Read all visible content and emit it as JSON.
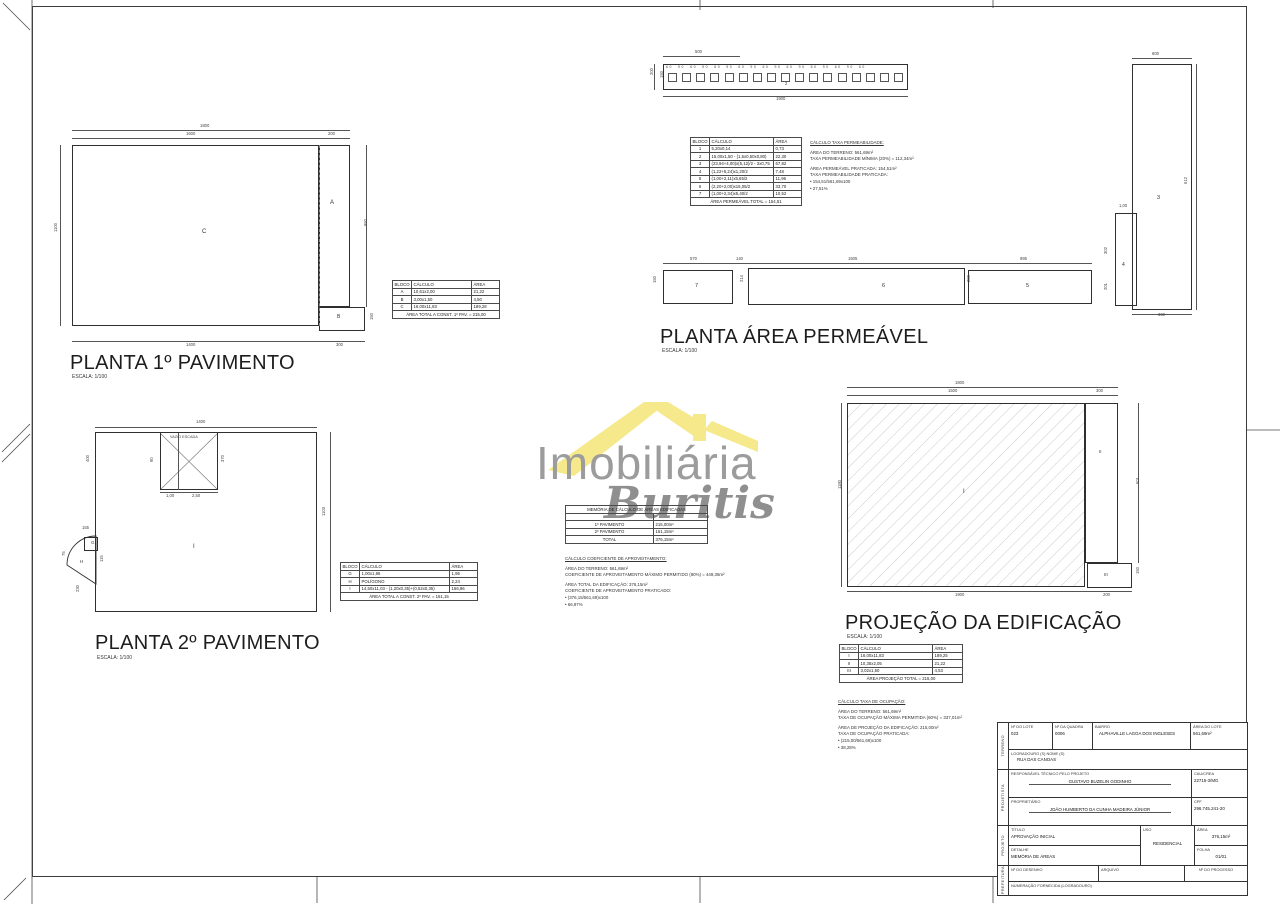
{
  "watermark": {
    "line1": "Imobiliária",
    "line2": "Buritis",
    "roof_color": "#f5e98b",
    "text_color": "#9c9c9c"
  },
  "plan1": {
    "title": "PLANTA 1º PAVIMENTO",
    "scale": "ESCALA: 1/100",
    "table": {
      "cols": [
        16,
        60,
        28
      ],
      "rows": [
        [
          "BLOCO",
          "CÁLCULO",
          "ÁREA"
        ],
        [
          "A",
          "10,61x2,00",
          "21,22"
        ],
        [
          "B",
          "3,00x1,50",
          "4,50"
        ],
        [
          "C",
          "16,00x11,83",
          "189,28"
        ],
        [
          "ÁREA TOTAL A CONST. 1º PAV. = 215,00"
        ]
      ]
    },
    "geo": [
      [
        72,
        130,
        278,
        0
      ],
      [
        72,
        138,
        278,
        0
      ],
      [
        60,
        145,
        0,
        181
      ],
      [
        366,
        145,
        0,
        162
      ],
      [
        72,
        341,
        293,
        0
      ],
      {
        "t": "1800",
        "x": 200,
        "y": 124
      },
      {
        "t": "1600",
        "x": 186,
        "y": 132
      },
      {
        "t": "200",
        "x": 328,
        "y": 132
      },
      {
        "t": "1100",
        "x": 54,
        "y": 232,
        "r": -90
      },
      {
        "t": "950",
        "x": 364,
        "y": 226,
        "r": -90
      },
      {
        "t": "1400",
        "x": 186,
        "y": 343
      },
      {
        "t": "300",
        "x": 336,
        "y": 343
      },
      {
        "t": "150",
        "x": 370,
        "y": 320,
        "r": -90
      },
      {
        "t": "A",
        "x": 330,
        "y": 200,
        "s": 6
      },
      {
        "t": "B",
        "x": 337,
        "y": 315,
        "s": 5
      },
      {
        "t": "C",
        "x": 202,
        "y": 229,
        "s": 6
      }
    ]
  },
  "perm": {
    "title": "PLANTA ÁREA PERMEÁVEL",
    "scale": "ESCALA: 1/100",
    "strip": {
      "squares": 17,
      "ticks": "60  90  60  90  60  90  60  90  60  90  60  90  60  90  60  90  60"
    },
    "strip_geo": [
      [
        663,
        56,
        77,
        0
      ],
      [
        663,
        96,
        245,
        0
      ],
      [
        654,
        64,
        0,
        26
      ],
      {
        "t": "500",
        "x": 695,
        "y": 50
      },
      {
        "t": "1900",
        "x": 776,
        "y": 97
      },
      {
        "t": "200",
        "x": 650,
        "y": 75,
        "r": -90
      },
      {
        "t": "150",
        "x": 660,
        "y": 78,
        "r": -90
      },
      {
        "t": "2",
        "x": 785,
        "y": 82
      }
    ],
    "table": {
      "cols": [
        16,
        64,
        28
      ],
      "rows": [
        [
          "BLOCO",
          "CÁLCULO",
          "ÁREA"
        ],
        [
          "1",
          "5,20x0,14",
          "0,73"
        ],
        [
          "2",
          "15,00x1,50 - (1,5x0,50x0,80)",
          "22,30"
        ],
        [
          "3",
          "(23,94+4,00)x(5,12)/2 - 3x0,75",
          "67,82"
        ],
        [
          "4",
          "(1,22+5,24)x1,20/2",
          "7,48"
        ],
        [
          "5",
          "(1,00+2,11)x5,65/2",
          "11,96"
        ],
        [
          "6",
          "(2,20+2,00)x15,05/2",
          "33,70"
        ],
        [
          "7",
          "(1,00+2,34)x5,40/2",
          "10,52"
        ],
        [
          "ÁREA PERMEÁVEL TOTAL = 154,51"
        ]
      ]
    },
    "calc": {
      "lines": [
        "CÁLCULO TAXA PERMEABILIDADE:",
        "",
        "ÁREA DO TERRENO: 561,69m²",
        "TAXA PERMEABILIDADE MÍNIMA (20%) = 112,34m²",
        "",
        "ÁREA PERMEÁVEL PRATICADA: 154,51m²",
        "TAXA PERMEABILIDADE PRATICADA:",
        "•    154,51/561,69x100",
        "•    27,51%"
      ]
    },
    "geo": [
      [
        663,
        263,
        429,
        0
      ],
      [
        1132,
        58,
        60,
        0
      ],
      [
        1196,
        64,
        0,
        246
      ],
      [
        1132,
        314,
        60,
        0
      ],
      {
        "t": "570",
        "x": 690,
        "y": 257
      },
      {
        "t": "140",
        "x": 736,
        "y": 257
      },
      {
        "t": "1505",
        "x": 848,
        "y": 257
      },
      {
        "t": "995",
        "x": 1020,
        "y": 257
      },
      {
        "t": "150",
        "x": 653,
        "y": 283,
        "r": -90
      },
      {
        "t": "214",
        "x": 740,
        "y": 282,
        "r": -90
      },
      {
        "t": "200",
        "x": 967,
        "y": 282,
        "r": -90
      },
      {
        "t": "600",
        "x": 1152,
        "y": 52
      },
      {
        "t": "612",
        "x": 1184,
        "y": 184,
        "r": -90
      },
      {
        "t": "1,00",
        "x": 1119,
        "y": 204
      },
      {
        "t": "302",
        "x": 1104,
        "y": 254,
        "r": -90
      },
      {
        "t": "201",
        "x": 1104,
        "y": 290,
        "r": -90
      },
      {
        "t": "360",
        "x": 1158,
        "y": 313
      },
      {
        "t": "7",
        "x": 695,
        "y": 284,
        "s": 5.5
      },
      {
        "t": "6",
        "x": 882,
        "y": 284,
        "s": 5.5
      },
      {
        "t": "5",
        "x": 1026,
        "y": 284,
        "s": 5.5
      },
      {
        "t": "3",
        "x": 1157,
        "y": 196,
        "s": 5.5
      },
      {
        "t": "4",
        "x": 1122,
        "y": 263,
        "s": 5
      }
    ]
  },
  "mem": {
    "table": {
      "cols": [
        88,
        54
      ],
      "rows": [
        [
          "MEMÓRIA DE CÁLCULO DE ÁREAS EDIFICADAS"
        ],
        [
          "",
          ""
        ],
        [
          "1º PAVIMENTO",
          "215,00m²"
        ],
        [
          "2º PAVIMENTO",
          "161,15m²"
        ],
        [
          "TOTAL",
          "376,15m²"
        ]
      ]
    }
  },
  "coef": {
    "lines": [
      "CÁLCULO COEFICIENTE DE APROVEITAMENTO:",
      "",
      "ÁREA DO TERRENO: 561,69m²",
      "COEFICIENTE DE APROVEITAMENTO MÁXIMO PERMITIDO (80%) = 449,35m²",
      "",
      "ÁREA TOTAL DA EDIFICAÇÃO: 376,15m²",
      "COEFICIENTE DE APROVEITAMENTO PRATICADO:",
      "•    (376,15/561,69)x100",
      "•    66,97%"
    ]
  },
  "plan2": {
    "title": "PLANTA 2º PAVIMENTO",
    "scale": "ESCALA: 1/100",
    "void_label": "VAZIO ESCADA",
    "table": {
      "cols": [
        16,
        90,
        28
      ],
      "rows": [
        [
          "BLOCO",
          "CÁLCULO",
          "ÁREA"
        ],
        [
          "G",
          "1,00x1,95",
          "1,95"
        ],
        [
          "H",
          "POLÍGONO",
          "2,24"
        ],
        [
          "I",
          "14,50x11,03 - (1,20x0,35)+(0,52x0,35)",
          "156,96"
        ],
        [
          "ÁREA TOTAL A CONST. 2º PAV. = 161,15"
        ]
      ]
    },
    "geo": [
      [
        95,
        427,
        222,
        0
      ],
      [
        330,
        432,
        0,
        180
      ],
      [
        160,
        492,
        58,
        0
      ],
      [
        178,
        433,
        0,
        57
      ],
      {
        "t": "1400",
        "x": 196,
        "y": 420
      },
      {
        "t": "400",
        "x": 86,
        "y": 462,
        "r": -90
      },
      {
        "t": "90",
        "x": 150,
        "y": 462,
        "r": -90
      },
      {
        "t": "370",
        "x": 221,
        "y": 462,
        "r": -90
      },
      {
        "t": "1,00",
        "x": 166,
        "y": 494
      },
      {
        "t": "2,50",
        "x": 192,
        "y": 494
      },
      {
        "t": "1103",
        "x": 322,
        "y": 516,
        "r": -90
      },
      {
        "t": "155",
        "x": 82,
        "y": 526
      },
      {
        "t": "75",
        "x": 62,
        "y": 556,
        "r": -90
      },
      {
        "t": "115",
        "x": 100,
        "y": 562,
        "r": -90
      },
      {
        "t": "230",
        "x": 76,
        "y": 592,
        "r": -90
      },
      {
        "t": "I",
        "x": 193,
        "y": 544,
        "s": 6
      },
      {
        "t": "G",
        "x": 91,
        "y": 541,
        "s": 4.5
      },
      {
        "t": "H",
        "x": 80,
        "y": 560,
        "s": 4.5
      }
    ]
  },
  "proj": {
    "title": "PROJEÇÃO DA EDIFICAÇÃO",
    "scale": "ESCALA: 1/100",
    "table": {
      "cols": [
        18,
        74,
        30
      ],
      "rows": [
        [
          "BLOCO",
          "CÁLCULO",
          "ÁREA"
        ],
        [
          "I",
          "16,00x11,83",
          "189,25"
        ],
        [
          "II",
          "10,35x2,05",
          "21,22"
        ],
        [
          "III",
          "3,02x1,50",
          "4,53"
        ],
        [
          "ÁREA PROJEÇÃO TOTAL = 215,00"
        ]
      ]
    },
    "occup": {
      "lines": [
        "CÁLCULO TAXA DE OCUPAÇÃO:",
        "",
        "ÁREA DO TERRENO: 561,69m²",
        "TAXA DE OCUPAÇÃO MÁXIMA PERMITIDA (60%) = 337,01m²",
        "",
        "ÁREA DE PROJEÇÃO DA EDIFICAÇÃO: 215,00m²",
        "TAXA DE OCUPAÇÃO PRATICADA:",
        "•    (215,00/561,69)x100",
        "•    38,28%"
      ]
    },
    "geo": [
      [
        847,
        387,
        271,
        0
      ],
      [
        847,
        395,
        271,
        0
      ],
      [
        841,
        403,
        0,
        184
      ],
      [
        1138,
        403,
        0,
        160
      ],
      [
        847,
        591,
        285,
        0
      ],
      {
        "t": "1800",
        "x": 955,
        "y": 381
      },
      {
        "t": "1500",
        "x": 948,
        "y": 389
      },
      {
        "t": "300",
        "x": 1096,
        "y": 389
      },
      {
        "t": "1180",
        "x": 838,
        "y": 489,
        "r": -90
      },
      {
        "t": "601",
        "x": 1136,
        "y": 484,
        "r": -90
      },
      {
        "t": "150",
        "x": 1136,
        "y": 574,
        "r": -90
      },
      {
        "t": "1900",
        "x": 955,
        "y": 593
      },
      {
        "t": "200",
        "x": 1103,
        "y": 593
      },
      {
        "t": "I",
        "x": 963,
        "y": 489,
        "s": 6
      },
      {
        "t": "II",
        "x": 1099,
        "y": 450,
        "s": 4.5
      },
      {
        "t": "III",
        "x": 1104,
        "y": 573,
        "s": 4.5
      }
    ]
  },
  "titleblock": {
    "terreno": {
      "v": "TERRENO",
      "lote_label": "Nº DO LOTE",
      "lote": "023",
      "quadra_label": "Nº DA QUADRA",
      "quadra": "0006",
      "bairro_label": "BAIRRO",
      "bairro": "ALPHAVILLE LAGOA DOS INGLESES",
      "area_label": "ÁREA DO LOTE",
      "area": "561,69m²",
      "logradouro_label": "LOGRADOURO (S) NOME (S)",
      "logradouro": "RUA DAS CANOAS"
    },
    "projetista": {
      "v": "PROJETISTA",
      "resp_label": "RESPONSÁVEL TÉCNICO PELO PROJETO",
      "resp": "GUSTAVO BUZELIN GODINHO",
      "cau_label": "CAU/CREA",
      "cau": "22715-3/MG",
      "prop_label": "PROPRIETÁRIO",
      "prop": "JOÃO HUMBERTO DA CUNHA MADEIRA JÚNIOR",
      "cpf_label": "CPF",
      "cpf": "296.745.241-20"
    },
    "projeto": {
      "v": "PROJETO",
      "titulo_label": "TÍTULO",
      "titulo": "APROVAÇÃO INICIAL",
      "detalhe_label": "DETALHE",
      "detalhe": "MEMÓRIA DE ÁREAS",
      "uso_label": "USO",
      "uso": "RESIDENCIAL",
      "area_label": "ÁREA",
      "area": "376,15m²",
      "folha_label": "FOLHA",
      "folha": "01/01"
    },
    "prefeitura": {
      "v": "PREFEITURA",
      "desenho_label": "Nº DO DESENHO",
      "arquivo_label": "ARQUIVO",
      "processo_label": "Nº DO PROCESSO",
      "numeracao_label": "NUMERAÇÃO FORNECIDA (LOGRADOURO)"
    }
  }
}
